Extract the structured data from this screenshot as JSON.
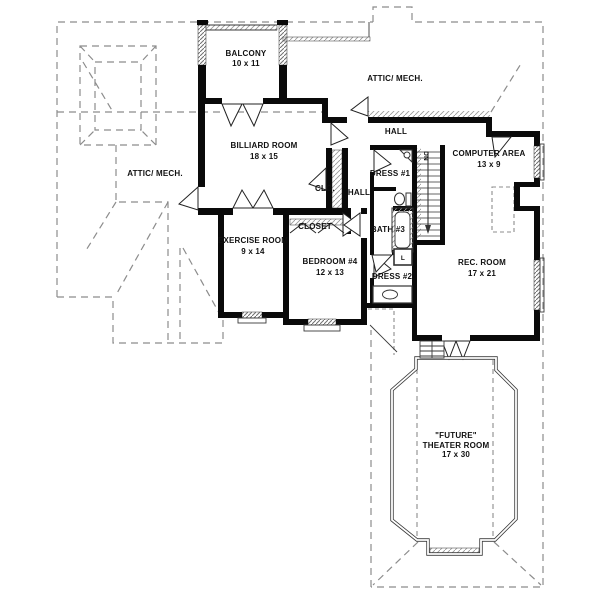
{
  "colors": {
    "wall": "#0a0a0a",
    "dash": "#8c8c8c",
    "thin": "#3a3a3a",
    "hatch": "#7a7a7a",
    "background": "#ffffff"
  },
  "rooms": [
    {
      "id": "balcony",
      "name": "BALCONY",
      "dims": "10 x 11"
    },
    {
      "id": "attic-right",
      "name": "ATTIC/ MECH.",
      "dims": ""
    },
    {
      "id": "attic-left",
      "name": "ATTIC/ MECH.",
      "dims": ""
    },
    {
      "id": "billiard-room",
      "name": "BILLIARD ROOM",
      "dims": "18 x 15"
    },
    {
      "id": "hall-upper",
      "name": "HALL",
      "dims": ""
    },
    {
      "id": "closet-clo",
      "name": "CLO.",
      "dims": ""
    },
    {
      "id": "hall-lower",
      "name": "HALL",
      "dims": ""
    },
    {
      "id": "dress-1",
      "name": "DRESS #1",
      "dims": ""
    },
    {
      "id": "computer-area",
      "name": "COMPUTER AREA",
      "dims": "13 x 9"
    },
    {
      "id": "bath-3",
      "name": "BATH #3",
      "dims": ""
    },
    {
      "id": "closet",
      "name": "CLOSET",
      "dims": ""
    },
    {
      "id": "exercise-room",
      "name": "EXERCISE ROOM",
      "dims": "9 x 14"
    },
    {
      "id": "bedroom-4",
      "name": "BEDROOM #4",
      "dims": "12 x 13"
    },
    {
      "id": "dress-2",
      "name": "DRESS #2",
      "dims": ""
    },
    {
      "id": "rec-room",
      "name": "REC. ROOM",
      "dims": "17 x 21"
    },
    {
      "id": "theater-room",
      "name": "\"FUTURE\"",
      "name2": "THEATER ROOM",
      "dims": "17 x 30"
    }
  ],
  "annotations": {
    "stairs_direction": "DN",
    "linen_closet": "L"
  }
}
